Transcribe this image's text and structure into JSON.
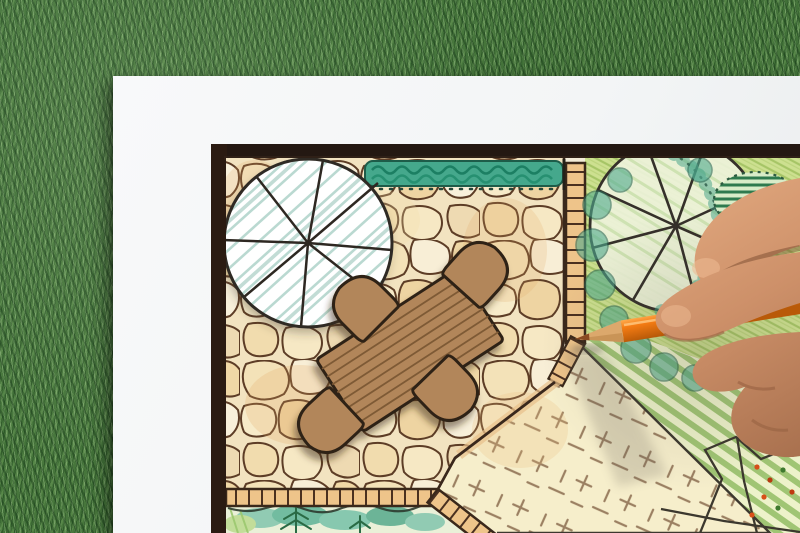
{
  "scene": {
    "description": "Close-up photograph of a hand holding an orange colored pencil over a hand-drawn garden landscape architecture plan on a white sheet of paper lying on green grass",
    "objects": [
      "green grass background",
      "white paper sheet",
      "black framed garden plan drawing",
      "flagstone patio paving",
      "round shade tree symbol with radial spokes",
      "clipped hedge strip",
      "rectangular wooden table symbol",
      "four chair symbols",
      "brick lawn edging band",
      "ladder style path edging",
      "planting bed with conifer sketch",
      "lawn area with cross hatch marks",
      "striped green lawn",
      "second round tree symbol",
      "hatched shrub symbol",
      "flower bed outlines with red dots",
      "artist hand",
      "orange colored pencil"
    ],
    "colors": {
      "grass_green": "#47763c",
      "paper_white": "#f4f6f7",
      "frame_black": "#241812",
      "stone_cream": "#f2e3c0",
      "stone_outline": "#5d3d26",
      "furniture_brown": "#b2865a",
      "hedge_teal": "#3f9f85",
      "tree_hatch_blue": "#b7d7cf",
      "lawn_yellow_green": "#cde090",
      "stripe_green": "#93bd65",
      "edging_tan": "#ecc084",
      "pencil_orange": "#f0781e",
      "skin_tone": "#cd9069"
    }
  }
}
